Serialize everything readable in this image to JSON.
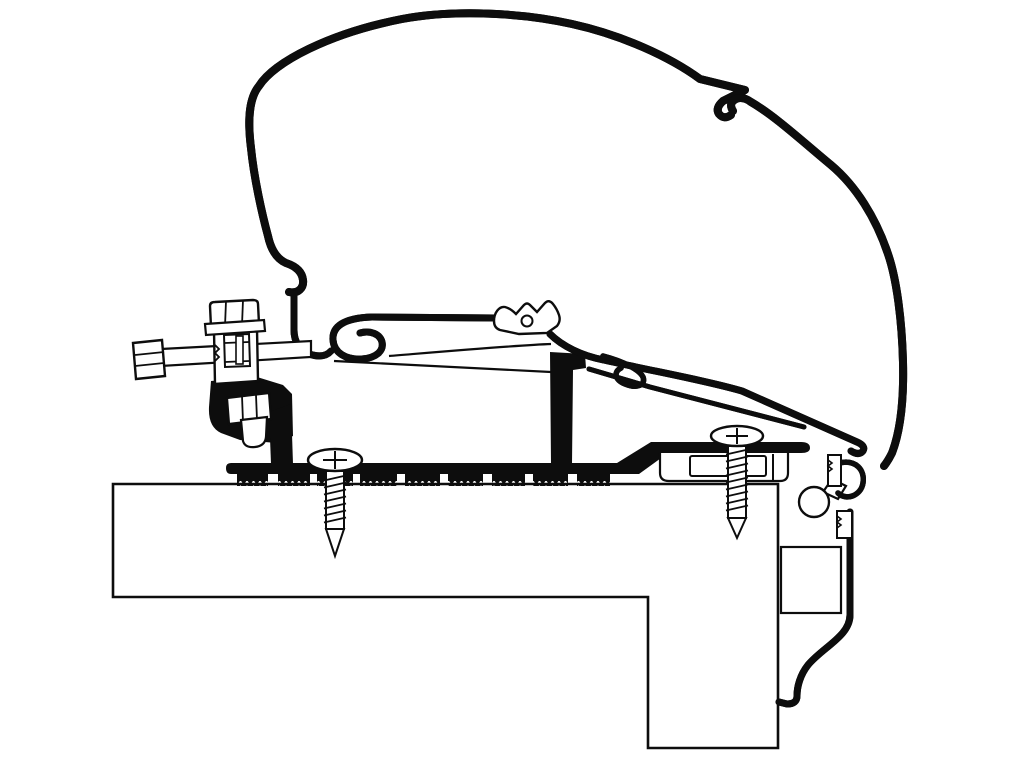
{
  "meta": {
    "title": "Awning roof-mount adapter — technical cross-section drawing",
    "background_color": "#ffffff",
    "line_color": "#0d0d0d"
  },
  "figure": {
    "aria_label": "Black-and-white technical cross-section line drawing: an awning cassette shell clamped to a mounting bracket profile, fixed by an adapter rail with two screws onto a hatched vehicle roof section; at the right a side-wall rail and wall profile.",
    "width": 1024,
    "height": 768
  },
  "components": {
    "roof_section": "Vehicle roof cross-section (hatched)",
    "wall_box": "Wall cavity section box",
    "wall_profile": "Side-wall profile strip",
    "wall_rail": "Side-wall awning rail with bulb and hook",
    "adapter_rail": "Roof adapter rail with serrated foot pads",
    "adapter_post": "Adapter rail support post",
    "adapter_foot": "Adapter rear foot block",
    "bracket_profile": "Awning mounting bracket profile",
    "bracket_screw_boss": "Bracket screw-channel boss",
    "bracket_rear_hook": "Bracket rear hook",
    "bracket_support_arm": "Bracket support arm",
    "cassette_shell": "Awning cassette shell",
    "cassette_joint": "Cassette shell joint notch",
    "cassette_lip": "Cassette front mounting lip",
    "clamp_block": "Clamp block",
    "clamp_bolt_top": "Vertical clamp bolt",
    "clamp_bolt_side": "Horizontal adjustment bolt",
    "clamp_nut": "Clamp nut and bolt end",
    "screw_front": "Front roof fixing screw",
    "screw_rear": "Rear roof fixing screw"
  }
}
